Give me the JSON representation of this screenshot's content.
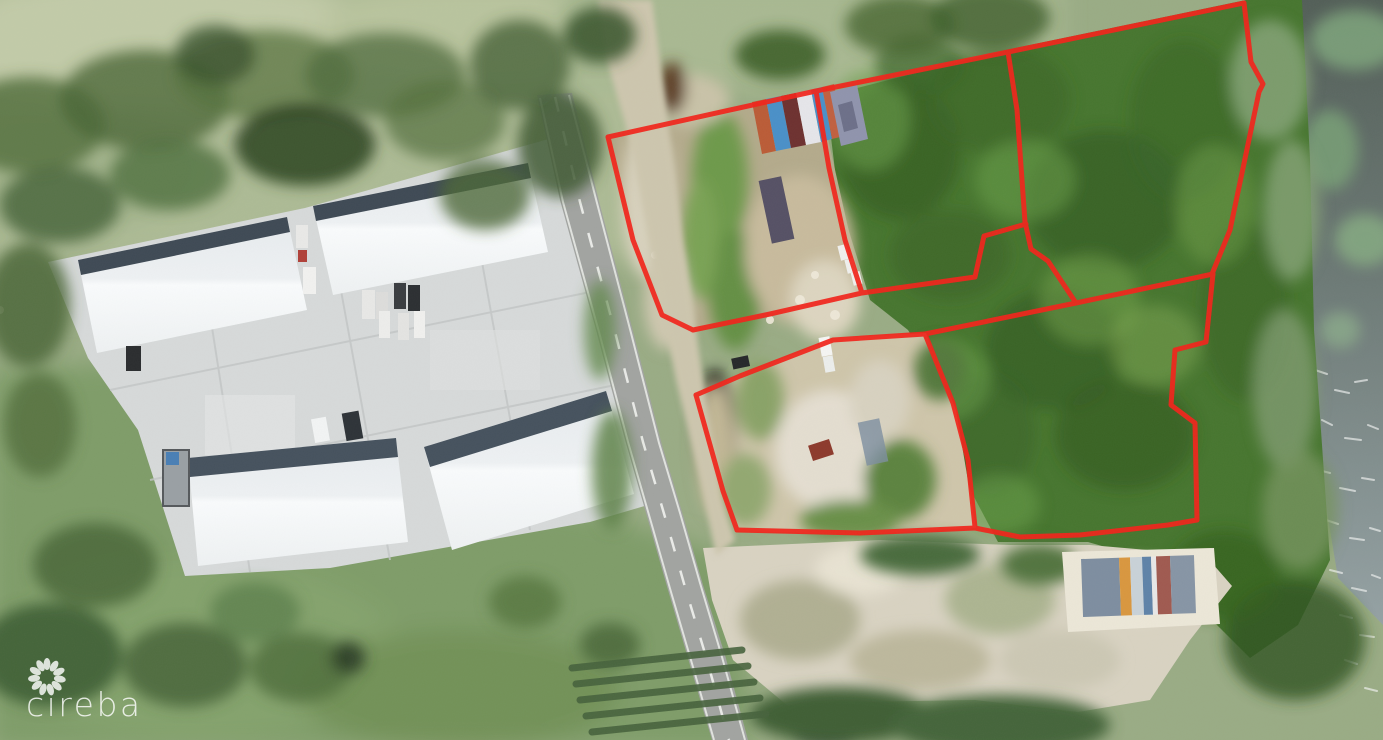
{
  "watermark": {
    "brand": "cireba"
  },
  "colors": {
    "boundary_red": "#f1251b",
    "forest_green": "#47762f",
    "pale_grass": "#adbb95",
    "lawn_green": "#7f9d69",
    "concrete": "#d7dada",
    "warehouse_roof": "#edf0f2",
    "roof_shadow_band": "#46525e",
    "road_asphalt": "#a2a4a1",
    "sand": "#d3ccb6",
    "water_dark": "#535f58",
    "water_choppy": "#95a2a4"
  },
  "boundaries": {
    "color": "#f1251b",
    "stroke_width": 5,
    "segments": [
      {
        "name": "north-parcels-top-edge",
        "points": "608,137 816,91 1008,52 1244,3"
      },
      {
        "name": "east-parcel-east-edge",
        "points": "1244,3 1251,62 1263,84 1259,92 1230,230 1212,274"
      },
      {
        "name": "northwest-parcel-west-edge",
        "points": "608,137 633,240 662,315 693,330"
      },
      {
        "name": "north-parcels-south-edge",
        "points": "693,330 770,314 862,293 975,277 984,236 1026,224"
      },
      {
        "name": "divider-northwest-middle",
        "points": "816,91 829,168 845,240 862,293"
      },
      {
        "name": "divider-middle-east",
        "points": "1008,52 1017,110 1025,222 1031,249 1048,261 1076,303"
      },
      {
        "name": "south-parcels-north-edge",
        "points": "925,334 1076,303 1213,274"
      },
      {
        "name": "southwest-parcel-north-edge",
        "points": "696,395 740,376 833,340 925,334"
      },
      {
        "name": "southwest-parcel-west-edge",
        "points": "696,395 723,491 737,530"
      },
      {
        "name": "south-parcels-south-edge",
        "points": "737,530 860,533 975,528 1020,537 1080,535 1168,525 1197,520"
      },
      {
        "name": "divider-south-parcels",
        "points": "925,334 953,403 968,460 975,527"
      },
      {
        "name": "southeast-parcel-east-edge",
        "points": "1213,274 1206,342 1175,350 1171,405 1195,423 1197,520"
      }
    ]
  }
}
